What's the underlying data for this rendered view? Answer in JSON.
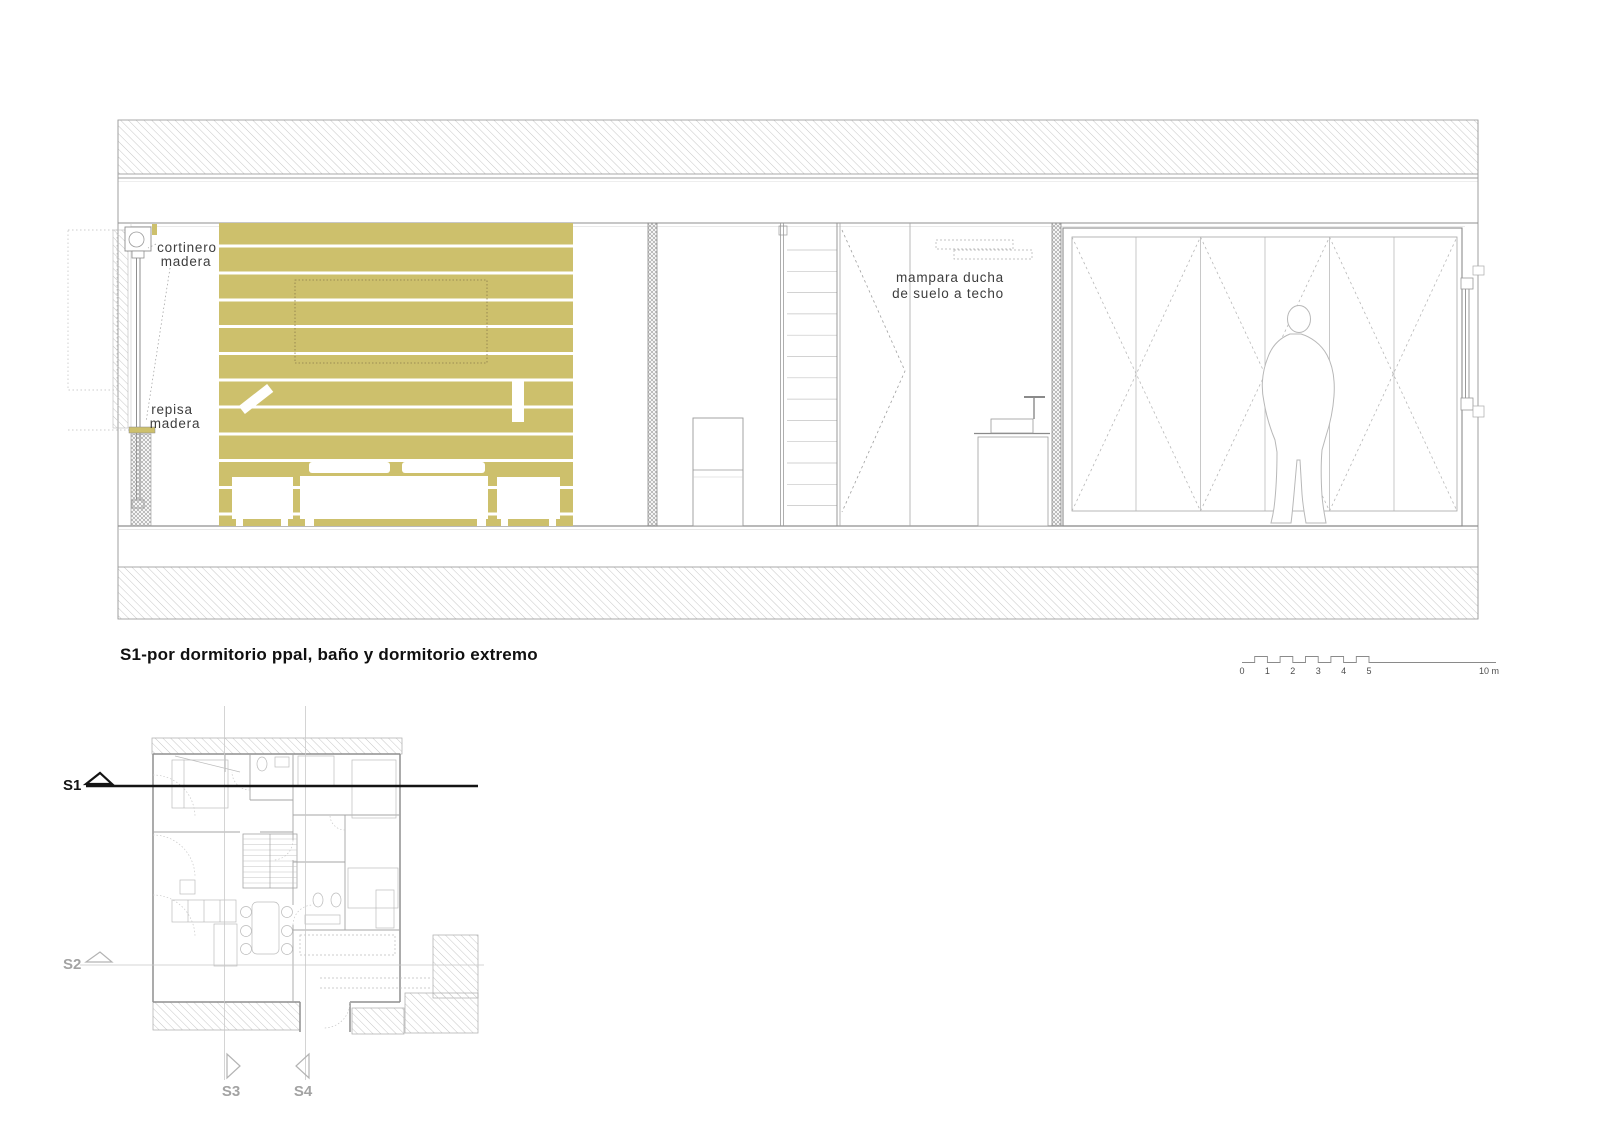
{
  "colors": {
    "wood": "#cdc06c",
    "section_line_dark": "#141414",
    "gray_label": "#a3a3a3"
  },
  "section": {
    "title": "S1-por dormitorio ppal, baño y dormitorio extremo",
    "annotations": {
      "cortinero_line1": "cortinero",
      "cortinero_line2": "madera",
      "repisa_line1": "repisa",
      "repisa_line2": "madera",
      "mampara_line1": "mampara ducha",
      "mampara_line2": "de suelo a techo"
    }
  },
  "scale_bar": {
    "labels": [
      "0",
      "1",
      "2",
      "3",
      "4",
      "5"
    ],
    "end_label": "10 m"
  },
  "plan": {
    "markers": {
      "s1": "S1",
      "s2": "S2",
      "s3": "S3",
      "s4": "S4"
    }
  }
}
